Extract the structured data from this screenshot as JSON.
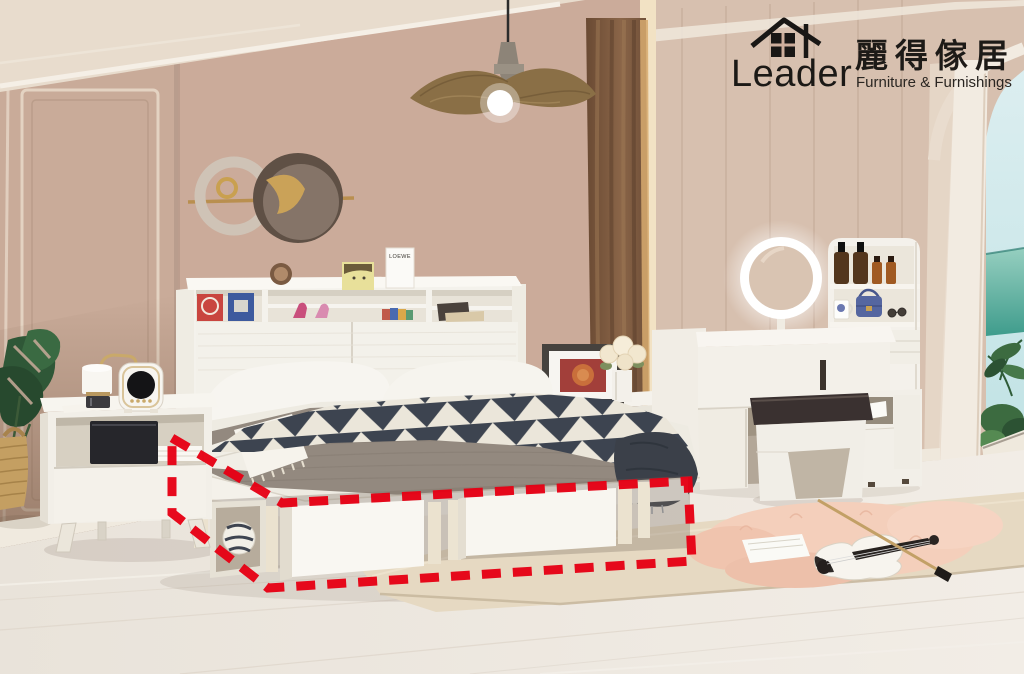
{
  "canvas": {
    "width": 1024,
    "height": 674
  },
  "brand": {
    "logo_icon": "house-icon",
    "name_en": "Leader",
    "name_zh": "麗得傢居",
    "tagline": "Furniture & Furnishings",
    "text_color": "#1b1916"
  },
  "decor": {
    "shelf_box_label": "LOEWE"
  },
  "highlight": {
    "type": "dashed-outline",
    "purpose": "under-bed-storage-highlight",
    "color": "#e60014",
    "dash": "19 12"
  },
  "palette": {
    "wall_back": "#cbab9a",
    "wall_left": "#c9ab99",
    "wall_left_shadow": "#8f7463",
    "wall_right": "#d7c0af",
    "ceiling": "#e8dccd",
    "floor": "#ece6de",
    "rug": "#e6d9c2",
    "fluffy_rug": "#f4cfbb",
    "curtain": "#7c5a42",
    "curtain_gold_edge": "#d8ab70",
    "furniture_white": "#f4f1ea",
    "mattress_gray": "#93897f",
    "blanket_navy": "#3d4450",
    "blanket_cream": "#ebe6da",
    "stool_cushion": "#3a3130",
    "sky": "#d2e9ec",
    "sea": "#4ea99b",
    "gold_metal": "#c9a96a"
  },
  "scene_objects": [
    "pendant-lamp",
    "wall-art",
    "arched-window",
    "curtain",
    "monstera-plant",
    "woven-basket",
    "nightstand",
    "table-lamp",
    "alarm-clock",
    "bed",
    "headboard-shelf",
    "pillows",
    "triangle-blanket",
    "under-bed-storage-boxes",
    "side-table",
    "picture-frame",
    "flower-vase",
    "vanity-desk",
    "led-mirror",
    "cosmetics-shelf",
    "vanity-stool",
    "side-cabinet",
    "area-rug",
    "fluffy-rug",
    "violin",
    "violin-bow"
  ]
}
